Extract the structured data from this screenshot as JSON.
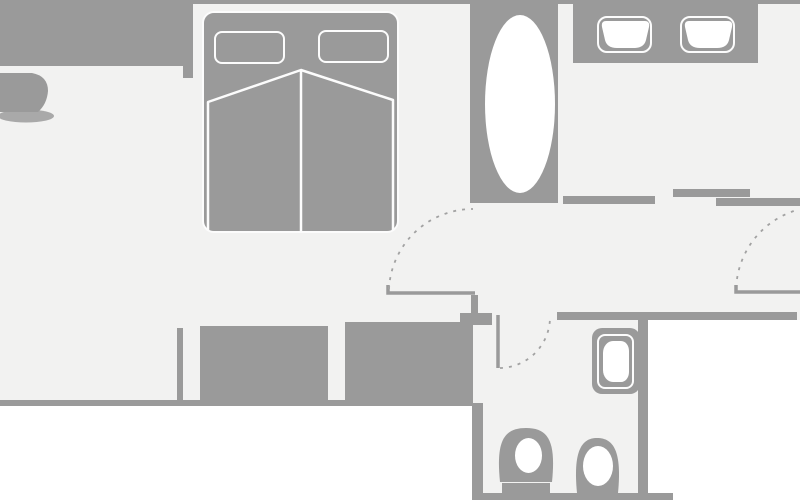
{
  "meta": {
    "type": "floor-plan",
    "width": 800,
    "height": 500
  },
  "colors": {
    "background": "#ffffff",
    "floor": "#f2f2f1",
    "wall": "#9a9a9a",
    "outline": "#fcfcfc",
    "fixture": "#ffffff",
    "dash": "#a2a2a2",
    "shadow": "#a9a9a9",
    "none": "none"
  },
  "plan": {
    "rects": [
      {
        "name": "floor-main",
        "x": 0,
        "y": 0,
        "w": 800,
        "h": 320,
        "fill": "floor"
      },
      {
        "name": "floor-living-south",
        "x": 0,
        "y": 320,
        "w": 473,
        "h": 80,
        "fill": "floor"
      },
      {
        "name": "floor-bathroom",
        "x": 472,
        "y": 320,
        "w": 176,
        "h": 173,
        "fill": "floor"
      },
      {
        "name": "wall-top-left-band",
        "x": 0,
        "y": 0,
        "w": 183,
        "h": 66,
        "fill": "wall"
      },
      {
        "name": "wall-top-stub",
        "x": 183,
        "y": 0,
        "w": 10,
        "h": 78,
        "fill": "wall"
      },
      {
        "name": "wall-top-thin",
        "x": 193,
        "y": 0,
        "w": 607,
        "h": 4,
        "fill": "wall"
      },
      {
        "name": "wall-tub-block",
        "x": 470,
        "y": 0,
        "w": 88,
        "h": 203,
        "fill": "wall"
      },
      {
        "name": "wall-vanity-counter",
        "x": 573,
        "y": 3,
        "w": 185,
        "h": 60,
        "fill": "wall"
      },
      {
        "name": "wall-hall-top",
        "x": 563,
        "y": 196,
        "w": 92,
        "h": 8,
        "fill": "wall"
      },
      {
        "name": "wall-slide-upper",
        "x": 673,
        "y": 189,
        "w": 77,
        "h": 8,
        "fill": "wall"
      },
      {
        "name": "wall-slide-lower",
        "x": 716,
        "y": 198,
        "w": 84,
        "h": 8,
        "fill": "wall"
      },
      {
        "name": "wall-door-stub",
        "x": 471,
        "y": 295,
        "w": 7,
        "h": 18,
        "fill": "wall"
      },
      {
        "name": "wall-bath-top",
        "x": 557,
        "y": 312,
        "w": 240,
        "h": 8,
        "fill": "wall"
      },
      {
        "name": "wall-bath-lip",
        "x": 460,
        "y": 313,
        "w": 32,
        "h": 12,
        "fill": "wall"
      },
      {
        "name": "wall-window-bar",
        "x": 177,
        "y": 328,
        "w": 6,
        "h": 72,
        "fill": "wall"
      },
      {
        "name": "wall-block-left",
        "x": 200,
        "y": 326,
        "w": 128,
        "h": 74,
        "fill": "wall"
      },
      {
        "name": "wall-block-right",
        "x": 345,
        "y": 322,
        "w": 128,
        "h": 81,
        "fill": "wall"
      },
      {
        "name": "wall-bottom-line",
        "x": 0,
        "y": 400,
        "w": 473,
        "h": 6,
        "fill": "wall"
      },
      {
        "name": "wall-bath-left",
        "x": 472,
        "y": 403,
        "w": 11,
        "h": 92,
        "fill": "wall"
      },
      {
        "name": "wall-bath-right",
        "x": 638,
        "y": 320,
        "w": 10,
        "h": 173,
        "fill": "wall"
      },
      {
        "name": "wall-bath-bottom",
        "x": 472,
        "y": 493,
        "w": 201,
        "h": 7,
        "fill": "wall"
      },
      {
        "name": "bed-frame",
        "x": 202,
        "y": 11,
        "w": 197,
        "h": 222,
        "fill": "wall",
        "radius": "12px",
        "stroke": "outline",
        "strokeWidth": 2
      },
      {
        "name": "pillow-left",
        "x": 214,
        "y": 31,
        "w": 71,
        "h": 33,
        "fill": "wall",
        "radius": "8px",
        "stroke": "outline",
        "strokeWidth": 2.5
      },
      {
        "name": "pillow-right",
        "x": 318,
        "y": 30,
        "w": 71,
        "h": 33,
        "fill": "wall",
        "radius": "8px",
        "stroke": "outline",
        "strokeWidth": 2.5
      },
      {
        "name": "bathtub",
        "x": 485,
        "y": 15,
        "w": 70,
        "h": 178,
        "fill": "fixture",
        "radius": "50%"
      },
      {
        "name": "sink-left-rim",
        "x": 597,
        "y": 16,
        "w": 55,
        "h": 37,
        "fill": "none",
        "radius": "10px",
        "stroke": "outline",
        "strokeWidth": 2.5
      },
      {
        "name": "sink-right-rim",
        "x": 680,
        "y": 16,
        "w": 55,
        "h": 37,
        "fill": "none",
        "radius": "10px",
        "stroke": "outline",
        "strokeWidth": 2.5
      },
      {
        "name": "vanity-unit",
        "x": 592,
        "y": 328,
        "w": 48,
        "h": 66,
        "fill": "wall",
        "radius": "10px"
      },
      {
        "name": "vanity-rim",
        "x": 597,
        "y": 334,
        "w": 37,
        "h": 55,
        "fill": "none",
        "radius": "8px",
        "stroke": "outline",
        "strokeWidth": 2.5
      },
      {
        "name": "vanity-basin",
        "x": 603,
        "y": 341,
        "w": 26,
        "h": 41,
        "fill": "fixture",
        "radius": "10px 8px 8px 10px / 12px 10px 10px 12px"
      }
    ],
    "svg": [
      {
        "tag": "ellipse",
        "name": "armchair-shadow",
        "attrs": {
          "cx": 26,
          "cy": 116,
          "rx": 28,
          "ry": 6.5,
          "fill": "shadow"
        }
      },
      {
        "tag": "path",
        "name": "armchair",
        "attrs": {
          "d": "M0,73 L32,73 Q48,76 48,91 Q47,104 38,112 L0,112 Z",
          "fill": "wall"
        }
      },
      {
        "tag": "path",
        "name": "duvet-outline",
        "attrs": {
          "d": "M208,231 L208,102 L301,70 L393,100 L393,231",
          "fill": "none",
          "stroke": "outline",
          "stroke-width": 2.5,
          "stroke-linejoin": "round"
        }
      },
      {
        "tag": "path",
        "name": "duvet-center-line",
        "attrs": {
          "d": "M301,70 L301,231",
          "fill": "none",
          "stroke": "outline",
          "stroke-width": 2.5
        }
      },
      {
        "tag": "path",
        "name": "sink-left-basin",
        "attrs": {
          "d": "M606,21 L645,21 Q650,21 649,27 L646,40 Q644,48 634,48 L617,48 Q607,48 605,40 L602,27 Q601,21 606,21 Z",
          "fill": "fixture"
        }
      },
      {
        "tag": "path",
        "name": "sink-right-basin",
        "attrs": {
          "d": "M689,21 L728,21 Q733,21 732,27 L729,40 Q727,48 717,48 L700,48 Q690,48 688,40 L685,27 Q684,21 689,21 Z",
          "fill": "fixture"
        }
      },
      {
        "tag": "path",
        "name": "toilet-left-body",
        "attrs": {
          "d": "M500,482 C496,442 503,428 526,428 C549,428 556,442 552,482 Z",
          "fill": "wall"
        }
      },
      {
        "tag": "ellipse",
        "name": "toilet-left-bowl",
        "attrs": {
          "cx": 528.5,
          "cy": 455.5,
          "rx": 13.5,
          "ry": 17.5,
          "fill": "fixture"
        }
      },
      {
        "tag": "path",
        "name": "toilet-left-base",
        "attrs": {
          "d": "M502,483 H550 V493 H502 Z",
          "fill": "wall"
        }
      },
      {
        "tag": "path",
        "name": "toilet-right-body",
        "attrs": {
          "d": "M577,493 C573,452 581,438 597,438 C614,438 622,452 618,493 Z",
          "fill": "wall"
        }
      },
      {
        "tag": "ellipse",
        "name": "toilet-right-bowl",
        "attrs": {
          "cx": 598,
          "cy": 466,
          "rx": 15,
          "ry": 20,
          "fill": "fixture"
        }
      },
      {
        "tag": "path",
        "name": "door-main-leaf",
        "attrs": {
          "d": "M388,285 L388,293 L475,293",
          "fill": "none",
          "stroke": "wall",
          "stroke-width": 3.5
        }
      },
      {
        "tag": "path",
        "name": "door-main-swing",
        "attrs": {
          "d": "M389,289 A84,84 0 0 1 473,209",
          "fill": "none",
          "stroke": "dash",
          "stroke-width": 1.8,
          "stroke-dasharray": "3 6"
        }
      },
      {
        "tag": "path",
        "name": "door-right-leaf",
        "attrs": {
          "d": "M736,285 L736,292 L800,292",
          "fill": "none",
          "stroke": "wall",
          "stroke-width": 3.5
        }
      },
      {
        "tag": "path",
        "name": "door-right-swing",
        "attrs": {
          "d": "M737,279 A85,85 0 0 1 797,210",
          "fill": "none",
          "stroke": "dash",
          "stroke-width": 1.8,
          "stroke-dasharray": "3 6"
        }
      },
      {
        "tag": "path",
        "name": "door-bath-leaf",
        "attrs": {
          "d": "M498,315 L498,368",
          "fill": "none",
          "stroke": "wall",
          "stroke-width": 3.5
        }
      },
      {
        "tag": "path",
        "name": "door-bath-swing",
        "attrs": {
          "d": "M500,368 A51,51 0 0 0 550,318",
          "fill": "none",
          "stroke": "dash",
          "stroke-width": 1.8,
          "stroke-dasharray": "3 6"
        }
      }
    ]
  }
}
